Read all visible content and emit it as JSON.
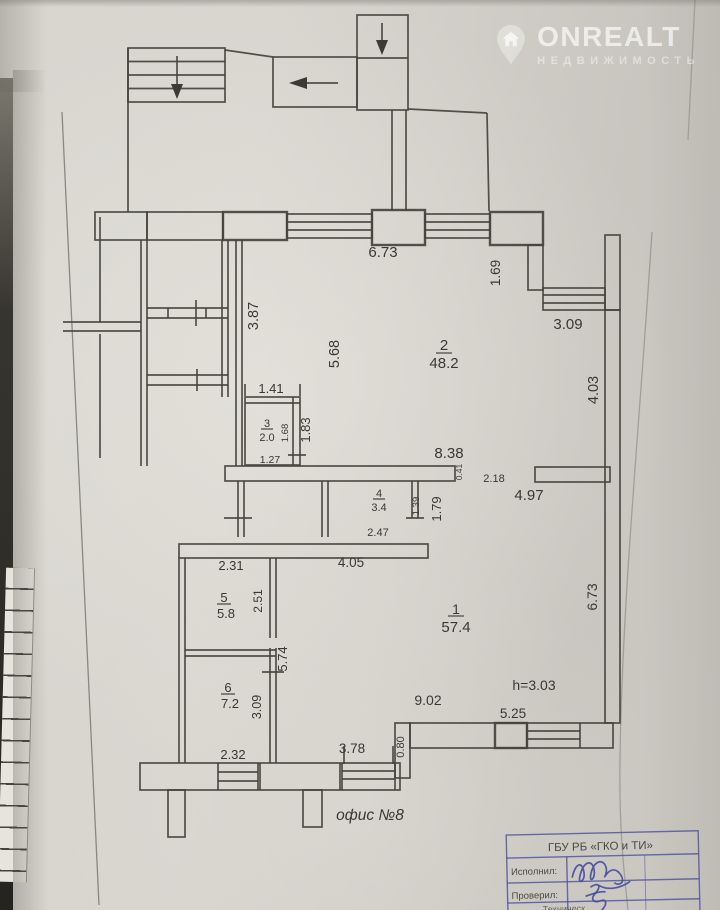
{
  "watermark": {
    "brand": "ONREALT",
    "tagline": "НЕДВИЖИМОСТЬ"
  },
  "plan": {
    "office_label": "офис №8",
    "height_note": "h=3.03",
    "rooms": [
      {
        "number": "1",
        "area": "57.4"
      },
      {
        "number": "2",
        "area": "48.2"
      },
      {
        "number": "3",
        "area": "2.0"
      },
      {
        "number": "4",
        "area": "3.4"
      },
      {
        "number": "5",
        "area": "5.8"
      },
      {
        "number": "6",
        "area": "7.2"
      }
    ],
    "dims": {
      "d673top": "6.73",
      "d169": "1.69",
      "d309tr": "3.09",
      "d403": "4.03",
      "d387": "3.87",
      "d568": "5.68",
      "d141": "1.41",
      "d168": "1.68",
      "d183": "1.83",
      "d127": "1.27",
      "d838": "8.38",
      "d041": "0.41",
      "d218": "2.18",
      "d497": "4.97",
      "d139": "1.39",
      "d179": "1.79",
      "d247": "2.47",
      "d231": "2.31",
      "d405": "4.05",
      "d251": "2.51",
      "d574": "5.74",
      "d673right": "6.73",
      "d902": "9.02",
      "d309b": "3.09",
      "d232": "2.32",
      "d378": "3.78",
      "d080": "0.80",
      "d525": "5.25"
    }
  },
  "stamp": {
    "org": "ГБУ РБ «ГКО и ТИ»",
    "row1": "Исполнил:",
    "row2": "Проверил:",
    "row3": "Техническ"
  }
}
